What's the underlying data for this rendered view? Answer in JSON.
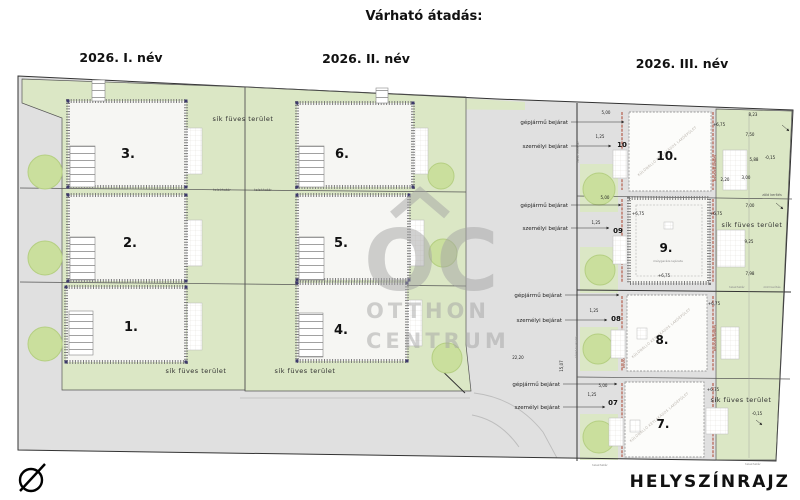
{
  "header": {
    "title": "Várható átadás:",
    "col1": "2026. I. név",
    "col2": "2026. II. név",
    "col3": "2026. III. név"
  },
  "footer": {
    "plan_title": "HELYSZÍNRAJZ"
  },
  "plots": {
    "p1": "1.",
    "p2": "2.",
    "p3": "3.",
    "p4": "4.",
    "p5": "5.",
    "p6": "6.",
    "p7": "7.",
    "p8": "8.",
    "p9": "9.",
    "p10": "10."
  },
  "plot_marks": {
    "m7": "07",
    "m8": "08",
    "m9": "09",
    "m10": "10"
  },
  "labels": {
    "grass": "sík füves terület",
    "boundary": "telekhatár",
    "green_fence": "zöld kerítés",
    "paving": "térkő burkolat",
    "vehicle_entrance": "gépjármű bejárat",
    "personal_entrance": "személyi bejárat",
    "red_line": "tervezett kerítés",
    "diag_building": "KÜLÖNÁLLÓ KÉTLAKÁSOS LAKÓÉPÜLET",
    "garage": "mélygarázs lejárata"
  },
  "dims": {
    "d500": "5,00",
    "d125": "1,25",
    "d823": "8,23",
    "d750": "7,50",
    "d588": "5,88",
    "d300": "3,00",
    "d220": "2,20",
    "d700": "7,00",
    "d925": "9,25",
    "d798": "7,98",
    "d2220": "22,20",
    "d1507": "15,07",
    "e675": "+6,75",
    "e015": "-0,15"
  },
  "watermark": {
    "initials": "OC",
    "line1": "OTTHON",
    "line2": "CENTRUM"
  },
  "colors": {
    "green": "#dbe7c5",
    "road": "#e0e0e0",
    "tree": "#cadf9d",
    "red_line": "#b0523f",
    "watermark": "#a5a5a5"
  }
}
